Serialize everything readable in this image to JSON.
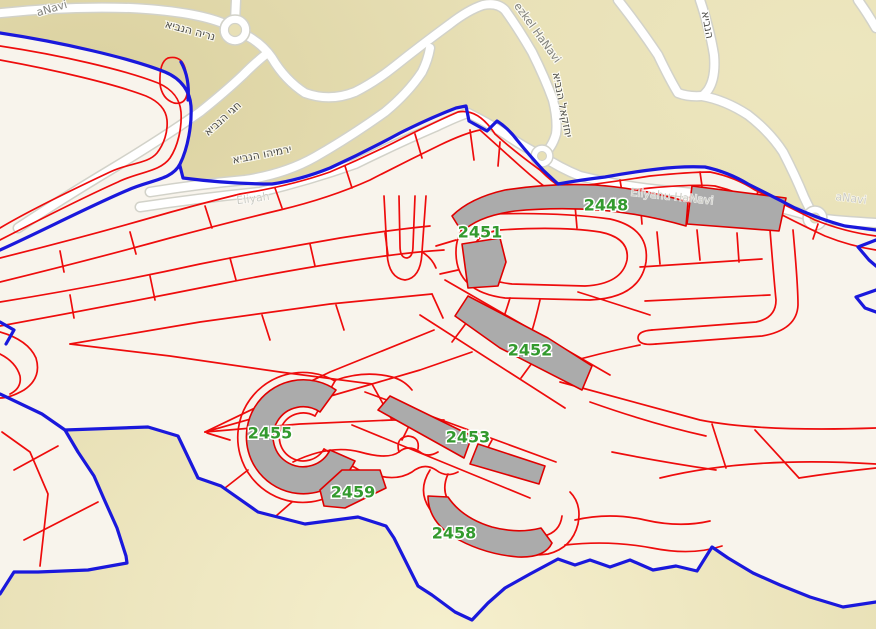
{
  "colors": {
    "terrain": "#e8e0b6",
    "terrain_dark": "#d8ce9c",
    "terrain_light": "#f6f0cf",
    "parcel_area": "#f8f4ec",
    "parcel_line": "#ee0c0c",
    "boundary": "#1a18dc",
    "building": "#ababab",
    "building_outline": "#e00000",
    "road": "#ffffff",
    "road_casing": "#d2d2c9",
    "label_green": "#339a2e",
    "street_dark": "#4c4c47",
    "street_mid": "#82827c",
    "street_faint": "#cbcbc3"
  },
  "parcel_labels": [
    {
      "id": "2448",
      "x": 606,
      "y": 206
    },
    {
      "id": "2451",
      "x": 480,
      "y": 233
    },
    {
      "id": "2452",
      "x": 530,
      "y": 351
    },
    {
      "id": "2453",
      "x": 468,
      "y": 438
    },
    {
      "id": "2455",
      "x": 270,
      "y": 434
    },
    {
      "id": "2459",
      "x": 353,
      "y": 493
    },
    {
      "id": "2458",
      "x": 454,
      "y": 534
    }
  ],
  "street_labels": [
    {
      "text": "נריה הנביא",
      "x": 190,
      "y": 31,
      "rot": 15,
      "style": "dark"
    },
    {
      "text": "aNavi",
      "x": 52,
      "y": 9,
      "rot": -16,
      "style": "mid"
    },
    {
      "text": "חגי הנביא",
      "x": 223,
      "y": 119,
      "rot": -42,
      "style": "dark"
    },
    {
      "text": "ירמיהו הנביא",
      "x": 262,
      "y": 155,
      "rot": -11,
      "style": "dark"
    },
    {
      "text": "ezkel HaNavi",
      "x": 537,
      "y": 33,
      "rot": 54,
      "style": "mid"
    },
    {
      "text": "יחזקאל הנביא",
      "x": 562,
      "y": 105,
      "rot": 79,
      "style": "dark"
    },
    {
      "text": "הנביא",
      "x": 707,
      "y": 25,
      "rot": 80,
      "style": "dark"
    },
    {
      "text": "Eliyahu HaNavi",
      "x": 672,
      "y": 197,
      "rot": 6,
      "style": "faint"
    },
    {
      "text": "aNavi",
      "x": 851,
      "y": 199,
      "rot": 7,
      "style": "faint"
    },
    {
      "text": "Eliyah",
      "x": 253,
      "y": 199,
      "rot": -8,
      "style": "faint"
    }
  ]
}
